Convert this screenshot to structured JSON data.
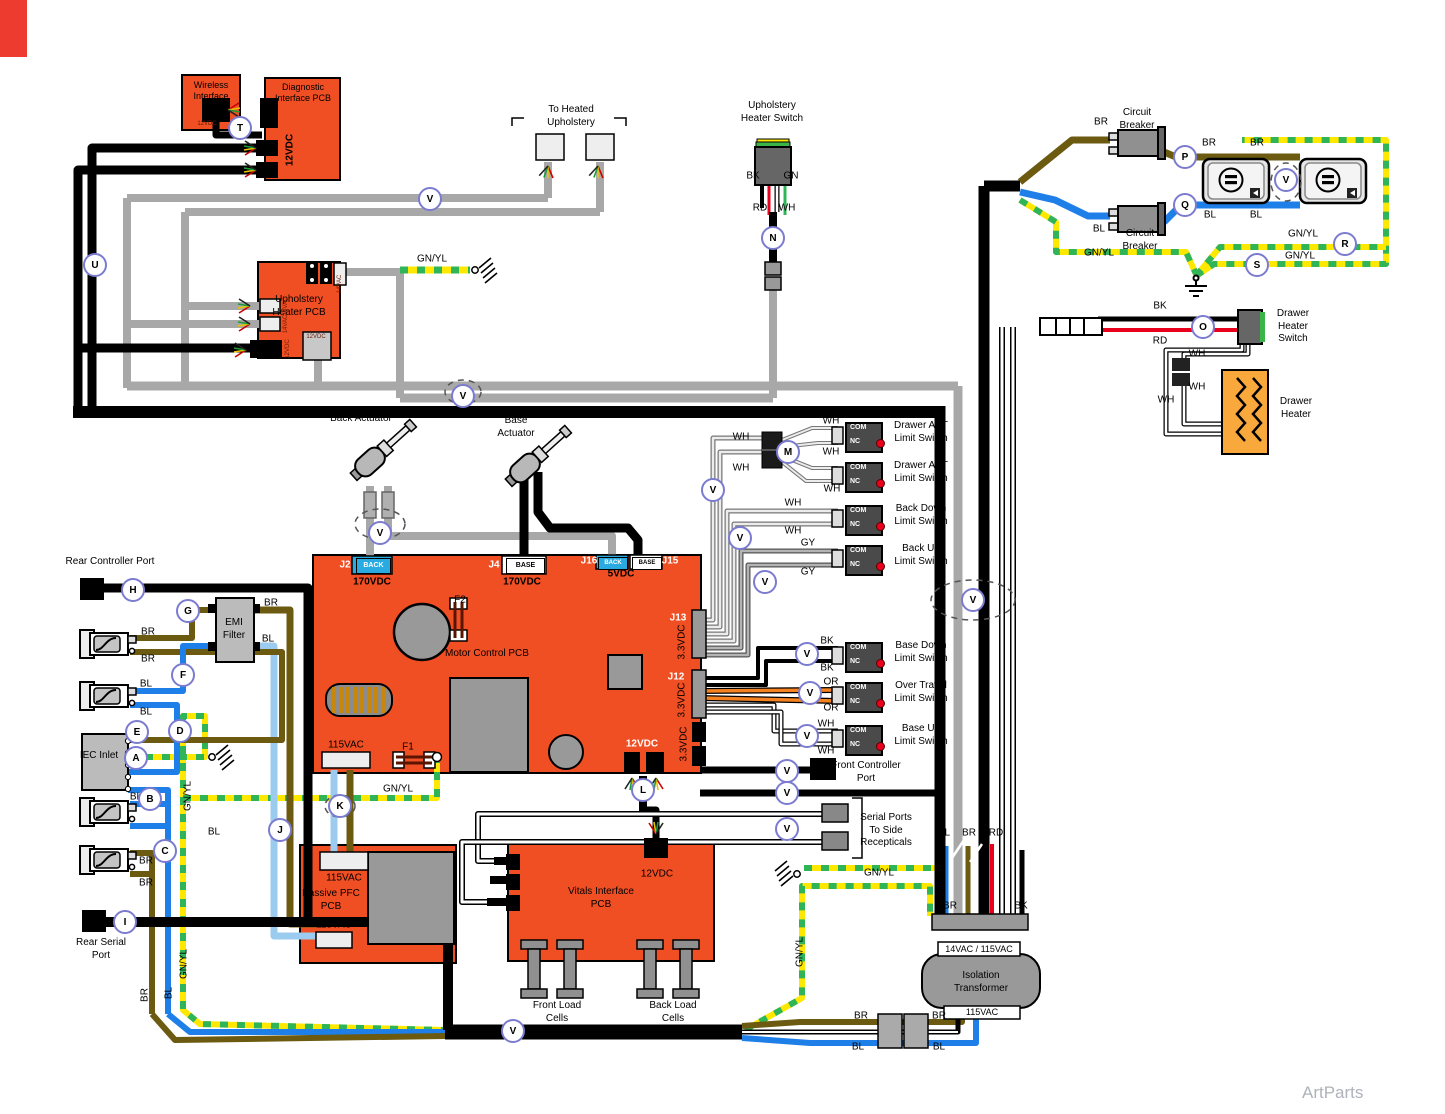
{
  "colors": {
    "pcb_orange": "#F04E23",
    "wire_black": "#000000",
    "wire_gray": "#A8A8A8",
    "wire_brown": "#6B5A10",
    "wire_blue": "#1E7FE8",
    "wire_lightblue": "#9CCBF0",
    "wire_red": "#E8001D",
    "wire_orange": "#F58220",
    "gnyl_yellow": "#FFE800",
    "gnyl_green": "#2FB457",
    "heater_orange": "#F9A83C",
    "marker_ring": "#7B7BD0",
    "limit_switch_body": "#4A4A4A",
    "tag_cyan": "#29ABE2"
  },
  "markers": {
    "a": "A",
    "b": "B",
    "c": "C",
    "d": "D",
    "e": "E",
    "f": "F",
    "g": "G",
    "h": "H",
    "i": "I",
    "j": "J",
    "k": "K",
    "l": "L",
    "m": "M",
    "n": "N",
    "o": "O",
    "p": "P",
    "q": "Q",
    "r": "R",
    "s": "S",
    "t": "T",
    "u": "U",
    "v": "V"
  },
  "wire_labels": [
    "BR",
    "BR",
    "BR",
    "BL",
    "BL",
    "BL",
    "GN/YL",
    "GN/YL",
    "GN/YL",
    "BK",
    "RD",
    "WH",
    "WH",
    "WH",
    "WH",
    "GN/YL",
    "BK",
    "GN",
    "RD",
    "WH",
    "WH",
    "WH",
    "WH",
    "WH",
    "WH",
    "WH",
    "WH",
    "WH",
    "GY",
    "GY",
    "BK",
    "BK",
    "OR",
    "OR",
    "WH",
    "WH",
    "BR",
    "BR",
    "BL",
    "BL",
    "BL",
    "BL",
    "BR",
    "BR",
    "BR",
    "BL",
    "BR",
    "BL",
    "GN/YL",
    "GN/YL",
    "GN/YL",
    "GN/YL",
    "GN/YL",
    "GN/YL",
    "BL",
    "BR",
    "RD",
    "BR",
    "BK",
    "BR",
    "BL",
    "BR",
    "BL"
  ],
  "components": {
    "wireless_pcb": {
      "title": "Wireless Interface PCB",
      "conn": "12VDC"
    },
    "diagnostic_pcb": {
      "title": "Diagnostic Interface PCB",
      "conn": "12VDC"
    },
    "heated_upholstery": {
      "label": "To Heated Upholstery"
    },
    "upholstery_switch": {
      "label": "Upholstery Heater Switch"
    },
    "upholstery_pcb": {
      "title": "Upholstery Heater PCB",
      "conn_14vac": "14VAC",
      "conn_12vdc": "12VDC"
    },
    "circuit_breaker": {
      "label": "Circuit Breaker"
    },
    "drawer_switch": {
      "line1": "Drawer",
      "line2": "Heater",
      "line3": "Switch"
    },
    "drawer_heater": {
      "line1": "Drawer",
      "line2": "Heater"
    },
    "back_actuator": {
      "label": "Back Actuator"
    },
    "base_actuator": {
      "label": "Base Actuator"
    },
    "motor_pcb": {
      "title": "Motor Control PCB",
      "j2": "J2",
      "j4": "J4",
      "j12": "J12",
      "j13": "J13",
      "j15": "J15",
      "j16": "J16",
      "tag_back": "BACK",
      "tag_base": "BASE",
      "v170": "170VDC",
      "v5": "5VDC",
      "v33": "3.3VDC",
      "v115": "115VAC",
      "v12": "12VDC",
      "f1": "F1",
      "f2": "F2"
    },
    "limit_switch_pins": {
      "com": "COM",
      "nc": "NC"
    },
    "limit_switches": [
      {
        "line1": "Drawer AST",
        "line2": "Limit Switch"
      },
      {
        "line1": "Drawer AST",
        "line2": "Limit Switch"
      },
      {
        "line1": "Back Down",
        "line2": "Limit Switch"
      },
      {
        "line1": "Back Up",
        "line2": "Limit Switch"
      },
      {
        "line1": "Base Down",
        "line2": "Limit Switch"
      },
      {
        "line1": "Over Travel",
        "line2": "Limit Switch"
      },
      {
        "line1": "Base Up",
        "line2": "Limit Switch"
      }
    ],
    "rear_controller_port": {
      "label": "Rear Controller Port"
    },
    "emi_filter": {
      "label": "EMI Filter"
    },
    "iec_inlet": {
      "label": "IEC Inlet"
    },
    "rear_serial_port": {
      "label": "Rear Serial Port"
    },
    "front_controller_port": {
      "label": "Front Controller Port"
    },
    "side_serial_ports": {
      "line1": "Serial Ports",
      "line2": "To Side",
      "line3": "Recepticals"
    },
    "passive_pfc": {
      "title": "Passive PFC PCB",
      "v115": "115VAC"
    },
    "vitals_pcb": {
      "title": "Vitals Interface PCB",
      "v12": "12VDC"
    },
    "front_load_cells": {
      "label": "Front Load Cells"
    },
    "back_load_cells": {
      "label": "Back Load Cells"
    },
    "isolation_transformer": {
      "label": "Isolation Transformer",
      "top": "14VAC /  115VAC",
      "bottom": "115VAC"
    }
  },
  "watermark": "ArtParts"
}
